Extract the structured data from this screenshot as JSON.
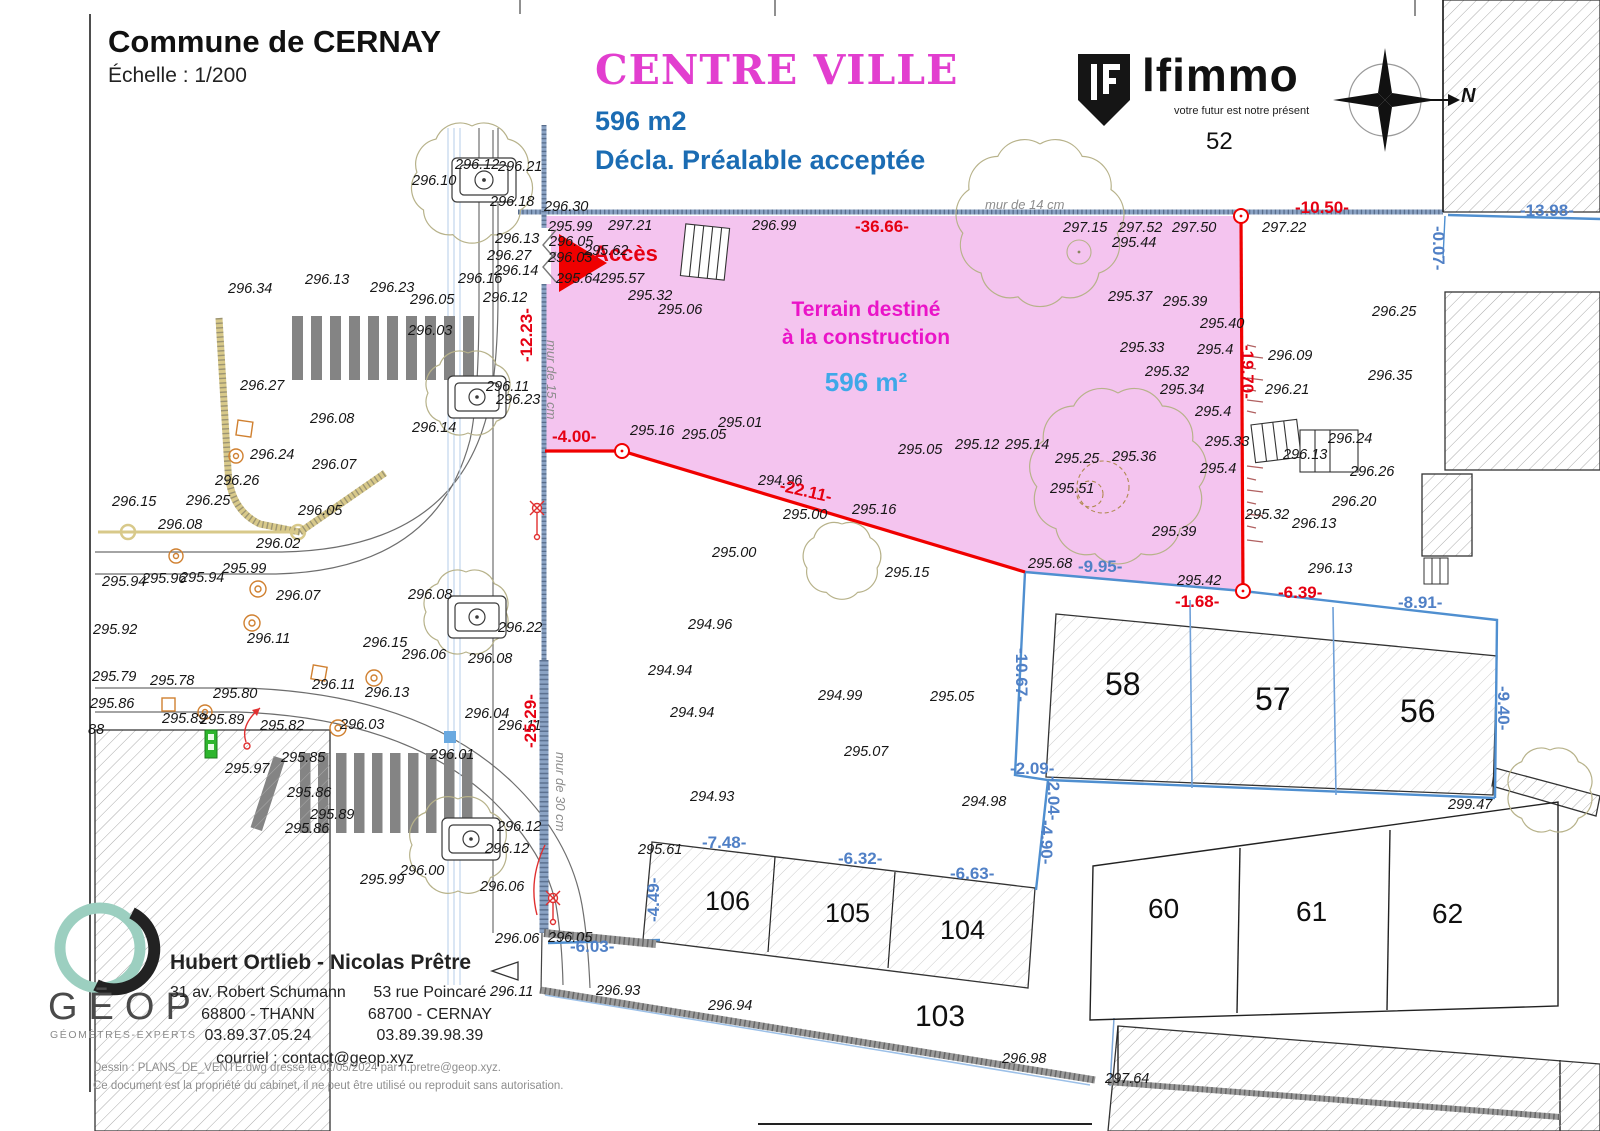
{
  "header": {
    "commune": "Commune de CERNAY",
    "echelle": "Échelle : 1/200",
    "zone": "CENTRE VILLE",
    "area": "596 m2",
    "decla": "Décla. Préalable acceptée"
  },
  "brand": {
    "name": "lfimmo",
    "tagline": "votre futur est notre présent",
    "parcel": "52"
  },
  "compass": {
    "north": "N"
  },
  "terrain": {
    "line1": "Terrain destiné",
    "line2": "à la construction",
    "area": "596 m²",
    "acces": "Accès"
  },
  "colors": {
    "terrain_fill": "#f4c4ef",
    "magenta": "#e23ecf",
    "blue_text": "#1b6cb3",
    "red": "#e60012",
    "dim_blue": "#5080c6",
    "area_blue": "#3fa8e8",
    "boundary_blue": "#4f8fd0",
    "wall_blue": "#8ba3c4"
  },
  "murs": [
    {
      "t": "mur de 14 cm",
      "x": 985,
      "y": 198
    },
    {
      "t": "mur de 15 cm",
      "x": 558,
      "y": 340,
      "r": 90
    },
    {
      "t": "mur de 30 cm",
      "x": 567,
      "y": 752,
      "r": 90
    }
  ],
  "dims_red": [
    {
      "t": "-36.66-",
      "x": 855,
      "y": 218
    },
    {
      "t": "-10.50-",
      "x": 1295,
      "y": 199
    },
    {
      "t": "-12.23-",
      "x": 518,
      "y": 362,
      "r": -90
    },
    {
      "t": "-4.00-",
      "x": 552,
      "y": 428
    },
    {
      "t": "-22.11-",
      "x": 782,
      "y": 477,
      "r": 13
    },
    {
      "t": "-19.70-",
      "x": 1256,
      "y": 345,
      "r": 90
    },
    {
      "t": "-25.29-",
      "x": 522,
      "y": 748,
      "r": -90
    },
    {
      "t": "-6.39-",
      "x": 1278,
      "y": 584
    },
    {
      "t": "-1.68-",
      "x": 1175,
      "y": 593
    }
  ],
  "dims_blue": [
    {
      "t": "-13.98-",
      "x": 1520,
      "y": 202
    },
    {
      "t": "-0.07-",
      "x": 1447,
      "y": 226,
      "r": 90
    },
    {
      "t": "-9.95-",
      "x": 1078,
      "y": 558
    },
    {
      "t": "-8.91-",
      "x": 1398,
      "y": 594
    },
    {
      "t": "-10.67-",
      "x": 1030,
      "y": 648,
      "r": 90
    },
    {
      "t": "-2.09-",
      "x": 1010,
      "y": 760
    },
    {
      "t": "-2.04-",
      "x": 1062,
      "y": 776,
      "r": 90
    },
    {
      "t": "-4.90-",
      "x": 1055,
      "y": 820,
      "r": 90
    },
    {
      "t": "-9.40-",
      "x": 1512,
      "y": 686,
      "r": 90
    },
    {
      "t": "-4.49-",
      "x": 645,
      "y": 922,
      "r": -90
    },
    {
      "t": "-7.48-",
      "x": 702,
      "y": 834
    },
    {
      "t": "-6.32-",
      "x": 838,
      "y": 850
    },
    {
      "t": "-6.63-",
      "x": 950,
      "y": 865
    },
    {
      "t": "-6.03-",
      "x": 570,
      "y": 938
    }
  ],
  "parcels": [
    {
      "t": "58",
      "x": 1105,
      "y": 668,
      "s": 32
    },
    {
      "t": "57",
      "x": 1255,
      "y": 683,
      "s": 32
    },
    {
      "t": "56",
      "x": 1400,
      "y": 695,
      "s": 32
    },
    {
      "t": "106",
      "x": 705,
      "y": 888,
      "s": 27
    },
    {
      "t": "105",
      "x": 825,
      "y": 900,
      "s": 27
    },
    {
      "t": "104",
      "x": 940,
      "y": 917,
      "s": 27
    },
    {
      "t": "103",
      "x": 915,
      "y": 1002,
      "s": 30
    },
    {
      "t": "60",
      "x": 1148,
      "y": 895,
      "s": 28
    },
    {
      "t": "61",
      "x": 1296,
      "y": 898,
      "s": 28
    },
    {
      "t": "62",
      "x": 1432,
      "y": 900,
      "s": 28
    }
  ],
  "elevations": [
    {
      "t": "296.12",
      "x": 455,
      "y": 158
    },
    {
      "t": "296.21",
      "x": 498,
      "y": 160
    },
    {
      "t": "296.10",
      "x": 412,
      "y": 174
    },
    {
      "t": "296.18",
      "x": 490,
      "y": 195
    },
    {
      "t": "296.30",
      "x": 544,
      "y": 200
    },
    {
      "t": "295.99",
      "x": 548,
      "y": 220
    },
    {
      "t": "297.21",
      "x": 608,
      "y": 219
    },
    {
      "t": "296.99",
      "x": 752,
      "y": 219
    },
    {
      "t": "296.05",
      "x": 549,
      "y": 235
    },
    {
      "t": "296.13",
      "x": 495,
      "y": 232
    },
    {
      "t": "296.27",
      "x": 487,
      "y": 249
    },
    {
      "t": "295.62",
      "x": 584,
      "y": 244
    },
    {
      "t": "296.03",
      "x": 548,
      "y": 251
    },
    {
      "t": "295.64",
      "x": 556,
      "y": 272
    },
    {
      "t": "295.57",
      "x": 600,
      "y": 272
    },
    {
      "t": "295.32",
      "x": 628,
      "y": 289
    },
    {
      "t": "295.06",
      "x": 658,
      "y": 303
    },
    {
      "t": "296.14",
      "x": 494,
      "y": 264
    },
    {
      "t": "296.16",
      "x": 458,
      "y": 272
    },
    {
      "t": "296.12",
      "x": 483,
      "y": 291
    },
    {
      "t": "296.11",
      "x": 486,
      "y": 380
    },
    {
      "t": "296.23",
      "x": 496,
      "y": 393
    },
    {
      "t": "296.34",
      "x": 228,
      "y": 282
    },
    {
      "t": "296.13",
      "x": 305,
      "y": 273
    },
    {
      "t": "296.23",
      "x": 370,
      "y": 281
    },
    {
      "t": "296.05",
      "x": 410,
      "y": 293
    },
    {
      "t": "296.03",
      "x": 408,
      "y": 324
    },
    {
      "t": "296.27",
      "x": 240,
      "y": 379
    },
    {
      "t": "296.08",
      "x": 310,
      "y": 412
    },
    {
      "t": "296.14",
      "x": 412,
      "y": 421
    },
    {
      "t": "296.24",
      "x": 250,
      "y": 448
    },
    {
      "t": "296.07",
      "x": 312,
      "y": 458
    },
    {
      "t": "296.26",
      "x": 215,
      "y": 474
    },
    {
      "t": "296.15",
      "x": 112,
      "y": 495
    },
    {
      "t": "296.25",
      "x": 186,
      "y": 494
    },
    {
      "t": "296.08",
      "x": 158,
      "y": 518
    },
    {
      "t": "296.05",
      "x": 298,
      "y": 504
    },
    {
      "t": "296.02",
      "x": 256,
      "y": 537
    },
    {
      "t": "295.99",
      "x": 222,
      "y": 562
    },
    {
      "t": "295.94",
      "x": 102,
      "y": 575
    },
    {
      "t": "295.96",
      "x": 142,
      "y": 572
    },
    {
      "t": "295.94",
      "x": 180,
      "y": 571
    },
    {
      "t": "296.07",
      "x": 276,
      "y": 589
    },
    {
      "t": "295.92",
      "x": 93,
      "y": 623
    },
    {
      "t": "296.11",
      "x": 247,
      "y": 632
    },
    {
      "t": "296.15",
      "x": 363,
      "y": 636
    },
    {
      "t": "296.06",
      "x": 402,
      "y": 648
    },
    {
      "t": "296.08",
      "x": 468,
      "y": 652
    },
    {
      "t": "296.08",
      "x": 408,
      "y": 588
    },
    {
      "t": "296.22",
      "x": 498,
      "y": 621
    },
    {
      "t": "296.04",
      "x": 465,
      "y": 707
    },
    {
      "t": "296.11",
      "x": 498,
      "y": 719
    },
    {
      "t": "296.01",
      "x": 430,
      "y": 748
    },
    {
      "t": "295.79",
      "x": 92,
      "y": 670
    },
    {
      "t": "295.78",
      "x": 150,
      "y": 674
    },
    {
      "t": "295.80",
      "x": 213,
      "y": 687
    },
    {
      "t": "295.86",
      "x": 90,
      "y": 697
    },
    {
      "t": "295.89",
      "x": 162,
      "y": 712
    },
    {
      "t": "295.89",
      "x": 200,
      "y": 713
    },
    {
      "t": "295.82",
      "x": 260,
      "y": 719
    },
    {
      "t": "296.11",
      "x": 312,
      "y": 678
    },
    {
      "t": "296.13",
      "x": 365,
      "y": 686
    },
    {
      "t": "296.03",
      "x": 340,
      "y": 718
    },
    {
      "t": "88",
      "x": 88,
      "y": 723
    },
    {
      "t": "295.97",
      "x": 225,
      "y": 762
    },
    {
      "t": "295.85",
      "x": 281,
      "y": 751
    },
    {
      "t": "295.86",
      "x": 287,
      "y": 786
    },
    {
      "t": "295.89",
      "x": 310,
      "y": 808
    },
    {
      "t": "295.86",
      "x": 285,
      "y": 822
    },
    {
      "t": "296.00",
      "x": 400,
      "y": 864
    },
    {
      "t": "295.99",
      "x": 360,
      "y": 873
    },
    {
      "t": "296.12",
      "x": 497,
      "y": 820
    },
    {
      "t": "296.12",
      "x": 485,
      "y": 842
    },
    {
      "t": "296.06",
      "x": 480,
      "y": 880
    },
    {
      "t": "296.06",
      "x": 495,
      "y": 932
    },
    {
      "t": "296.05",
      "x": 548,
      "y": 931
    },
    {
      "t": "296.11",
      "x": 490,
      "y": 985
    },
    {
      "t": "295.16",
      "x": 630,
      "y": 424
    },
    {
      "t": "295.05",
      "x": 682,
      "y": 428
    },
    {
      "t": "295.01",
      "x": 718,
      "y": 416
    },
    {
      "t": "294.96",
      "x": 758,
      "y": 474
    },
    {
      "t": "295.00",
      "x": 783,
      "y": 508
    },
    {
      "t": "295.16",
      "x": 852,
      "y": 503
    },
    {
      "t": "295.00",
      "x": 712,
      "y": 546
    },
    {
      "t": "295.15",
      "x": 885,
      "y": 566
    },
    {
      "t": "295.05",
      "x": 898,
      "y": 443
    },
    {
      "t": "295.12",
      "x": 955,
      "y": 438
    },
    {
      "t": "295.14",
      "x": 1005,
      "y": 438
    },
    {
      "t": "295.25",
      "x": 1055,
      "y": 452
    },
    {
      "t": "295.36",
      "x": 1112,
      "y": 450
    },
    {
      "t": "295.51",
      "x": 1050,
      "y": 482
    },
    {
      "t": "295.39",
      "x": 1152,
      "y": 525
    },
    {
      "t": "295.68",
      "x": 1028,
      "y": 557
    },
    {
      "t": "295.42",
      "x": 1177,
      "y": 574
    },
    {
      "t": "297.15",
      "x": 1063,
      "y": 221
    },
    {
      "t": "297.52",
      "x": 1118,
      "y": 221
    },
    {
      "t": "297.50",
      "x": 1172,
      "y": 221
    },
    {
      "t": "297.22",
      "x": 1262,
      "y": 221
    },
    {
      "t": "295.44",
      "x": 1112,
      "y": 236
    },
    {
      "t": "295.37",
      "x": 1108,
      "y": 290
    },
    {
      "t": "295.39",
      "x": 1163,
      "y": 295
    },
    {
      "t": "295.40",
      "x": 1200,
      "y": 317
    },
    {
      "t": "295.33",
      "x": 1120,
      "y": 341
    },
    {
      "t": "295.4",
      "x": 1197,
      "y": 343
    },
    {
      "t": "295.32",
      "x": 1145,
      "y": 365
    },
    {
      "t": "295.34",
      "x": 1160,
      "y": 383
    },
    {
      "t": "295.4",
      "x": 1195,
      "y": 405
    },
    {
      "t": "295.33",
      "x": 1205,
      "y": 435
    },
    {
      "t": "295.4",
      "x": 1200,
      "y": 462
    },
    {
      "t": "296.09",
      "x": 1268,
      "y": 349
    },
    {
      "t": "296.21",
      "x": 1265,
      "y": 383
    },
    {
      "t": "296.25",
      "x": 1372,
      "y": 305
    },
    {
      "t": "296.35",
      "x": 1368,
      "y": 369
    },
    {
      "t": "296.24",
      "x": 1328,
      "y": 432
    },
    {
      "t": "296.13",
      "x": 1283,
      "y": 448
    },
    {
      "t": "296.26",
      "x": 1350,
      "y": 465
    },
    {
      "t": "296.20",
      "x": 1332,
      "y": 495
    },
    {
      "t": "296.13",
      "x": 1292,
      "y": 517
    },
    {
      "t": "295.32",
      "x": 1245,
      "y": 508
    },
    {
      "t": "296.13",
      "x": 1308,
      "y": 562
    },
    {
      "t": "294.96",
      "x": 688,
      "y": 618
    },
    {
      "t": "294.94",
      "x": 648,
      "y": 664
    },
    {
      "t": "294.94",
      "x": 670,
      "y": 706
    },
    {
      "t": "294.93",
      "x": 690,
      "y": 790
    },
    {
      "t": "294.99",
      "x": 818,
      "y": 689
    },
    {
      "t": "295.05",
      "x": 930,
      "y": 690
    },
    {
      "t": "295.07",
      "x": 844,
      "y": 745
    },
    {
      "t": "294.98",
      "x": 962,
      "y": 795
    },
    {
      "t": "295.61",
      "x": 638,
      "y": 843
    },
    {
      "t": "299.47",
      "x": 1448,
      "y": 798
    },
    {
      "t": "296.93",
      "x": 596,
      "y": 984
    },
    {
      "t": "296.94",
      "x": 708,
      "y": 999
    },
    {
      "t": "296.98",
      "x": 1002,
      "y": 1052
    },
    {
      "t": "297.64",
      "x": 1105,
      "y": 1072
    }
  ],
  "geop": {
    "letters": "GĒOP",
    "subtitle": "GÉOMÈTRES-EXPERTS",
    "name": "Hubert Ortlieb - Nicolas Prêtre",
    "addr1a": "31 av. Robert Schumann",
    "addr1b": "68800 - THANN",
    "tel1": "03.89.37.05.24",
    "addr2a": "53 rue Poincaré",
    "addr2b": "68700 - CERNAY",
    "tel2": "03.89.39.98.39",
    "mail": "courriel : contact@geop.xyz"
  },
  "footer": {
    "l1": "Dessin : PLANS_DE_VENTE.dwg dressé le 02/05/2024 par n.pretre@geop.xyz.",
    "l2": "Ce document est la propriété du cabinet, il ne peut être utilisé ou reproduit sans autorisation."
  }
}
